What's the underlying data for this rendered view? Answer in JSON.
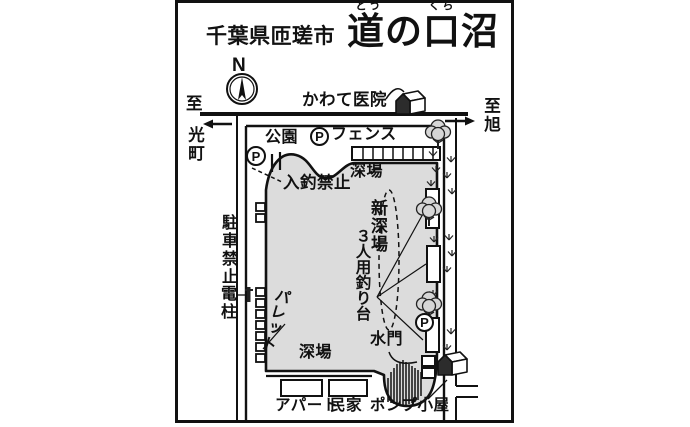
{
  "title": {
    "region": "千葉県匝瑳市",
    "name": "道の口沼",
    "ruby_dou": "どう",
    "ruby_kuchi": "くち"
  },
  "compass": {
    "north": "N"
  },
  "roads": {
    "dest_left_to": "至",
    "dest_left_name": "光町",
    "dest_right": "至旭"
  },
  "labels": {
    "clinic": "かわて医院",
    "park": "公園",
    "fence": "フェンス",
    "no_fishing_entry": "入釣禁止",
    "deep_area": "深場",
    "new_deep_area": "新深場",
    "three_person_platform": "３人用釣り台",
    "no_parking": "駐車禁止",
    "utility_pole": "電柱",
    "pallet": "パレット",
    "sluice_gate": "水門",
    "apartment": "アパート",
    "private_house": "民家",
    "pump_shed": "ポンプ小屋"
  },
  "icons": {
    "parking": "P"
  },
  "colors": {
    "pond": "#dcdcdc",
    "tree": "#d6d6d6",
    "line": "#111111",
    "bg": "#ffffff"
  }
}
